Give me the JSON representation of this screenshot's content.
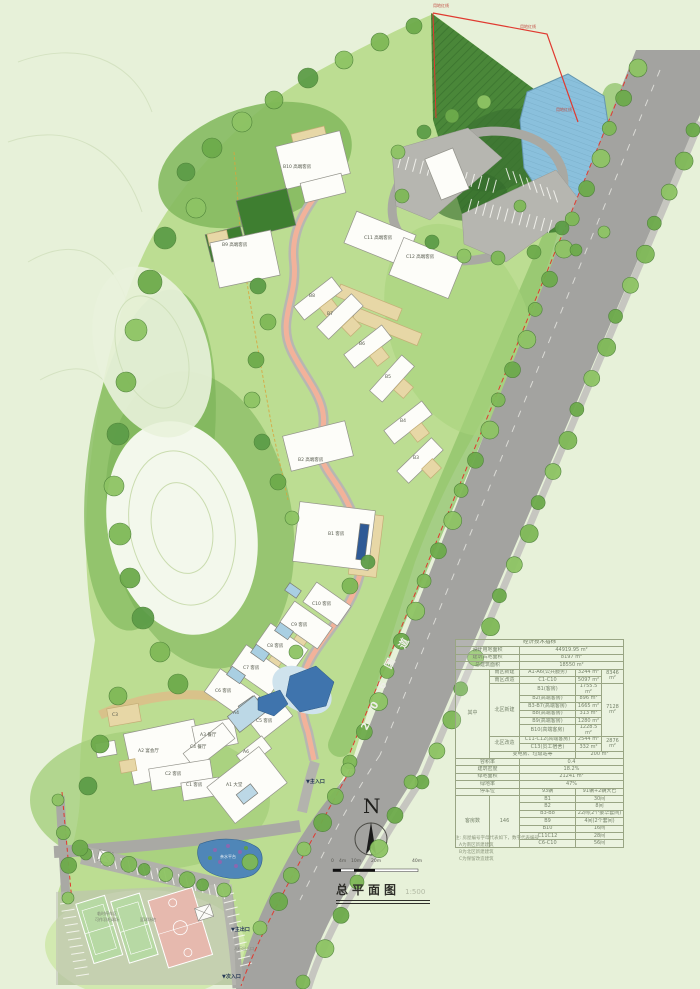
{
  "title": {
    "text": "总平面图",
    "scale": "1:500"
  },
  "north": {
    "letter": "N"
  },
  "scale_bar": {
    "ticks": [
      {
        "x": 331,
        "t": "0"
      },
      {
        "x": 339,
        "t": "4m"
      },
      {
        "x": 351,
        "t": "10m"
      },
      {
        "x": 371,
        "t": "20m"
      },
      {
        "x": 412,
        "t": "40m"
      }
    ]
  },
  "road": {
    "name": "206国道",
    "chars": [
      {
        "x": 363,
        "y": 722,
        "t": "2"
      },
      {
        "x": 372,
        "y": 701,
        "t": "0"
      },
      {
        "x": 380,
        "y": 681,
        "t": "6"
      },
      {
        "x": 386,
        "y": 659,
        "t": "国"
      },
      {
        "x": 400,
        "y": 639,
        "t": "道"
      }
    ]
  },
  "boundary": {
    "label": "用地红线",
    "positions": [
      [
        433,
        4
      ],
      [
        520,
        25
      ],
      [
        556,
        108
      ]
    ]
  },
  "entrances": [
    {
      "x": 306,
      "y": 780,
      "t": "▼主入口"
    },
    {
      "x": 231,
      "y": 928,
      "t": "▼主出口"
    },
    {
      "x": 234,
      "y": 947,
      "t": "人行出入口",
      "c": "s4g"
    },
    {
      "x": 222,
      "y": 975,
      "t": "▼次入口"
    }
  ],
  "building_labels": [
    {
      "x": 283,
      "y": 166,
      "t": "B10 高端客房"
    },
    {
      "x": 222,
      "y": 244,
      "t": "B9 高端客房"
    },
    {
      "x": 364,
      "y": 237,
      "t": "C11 高端客房"
    },
    {
      "x": 406,
      "y": 256,
      "t": "C12 高端客房"
    },
    {
      "x": 309,
      "y": 295,
      "t": "B8"
    },
    {
      "x": 327,
      "y": 313,
      "t": "B7"
    },
    {
      "x": 359,
      "y": 343,
      "t": "B6"
    },
    {
      "x": 385,
      "y": 376,
      "t": "B5"
    },
    {
      "x": 400,
      "y": 420,
      "t": "B4"
    },
    {
      "x": 413,
      "y": 457,
      "t": "B3"
    },
    {
      "x": 298,
      "y": 459,
      "t": "B2 高端客房"
    },
    {
      "x": 328,
      "y": 533,
      "t": "B1 客房"
    },
    {
      "x": 312,
      "y": 603,
      "t": "C10 客房"
    },
    {
      "x": 291,
      "y": 624,
      "t": "C9 客房"
    },
    {
      "x": 267,
      "y": 645,
      "t": "C8 客房"
    },
    {
      "x": 243,
      "y": 667,
      "t": "C7 客房"
    },
    {
      "x": 215,
      "y": 690,
      "t": "C6 客房"
    },
    {
      "x": 256,
      "y": 720,
      "t": "C5 客房"
    },
    {
      "x": 233,
      "y": 712,
      "t": "A4"
    },
    {
      "x": 200,
      "y": 734,
      "t": "A3 餐厅"
    },
    {
      "x": 190,
      "y": 746,
      "t": "C4 餐厅"
    },
    {
      "x": 138,
      "y": 750,
      "t": "A2 宴会厅"
    },
    {
      "x": 243,
      "y": 751,
      "t": "A6"
    },
    {
      "x": 112,
      "y": 714,
      "t": "C3"
    },
    {
      "x": 165,
      "y": 773,
      "t": "C2 客房"
    },
    {
      "x": 186,
      "y": 784,
      "t": "C1 客房"
    },
    {
      "x": 226,
      "y": 784,
      "t": "A1 大堂"
    }
  ],
  "site_labels": [
    {
      "x": 97,
      "y": 912,
      "t": "临时停车区",
      "c": "s4g"
    },
    {
      "x": 95,
      "y": 918,
      "t": "可作羽毛球场",
      "c": "s4g"
    },
    {
      "x": 140,
      "y": 918,
      "t": "篮球场地",
      "c": "s4g"
    },
    {
      "x": 220,
      "y": 855,
      "t": "亲水平台",
      "c": "s4w"
    }
  ],
  "table": {
    "title": "经济技术指标",
    "rows": [
      [
        {
          "t": "设计用地面积",
          "cs": 2
        },
        {
          "t": "44919.95 m²",
          "cs": 3
        }
      ],
      [
        {
          "t": "建筑占地面积",
          "cs": 2
        },
        {
          "t": "8197 m²",
          "cs": 3
        }
      ],
      [
        {
          "t": "总建筑面积",
          "cs": 2
        },
        {
          "t": "18550 m²",
          "cs": 3
        }
      ],
      [
        {
          "t": "其中",
          "rs": 11
        },
        {
          "t": "南区新建"
        },
        {
          "t": "A1-A6(公共服务)"
        },
        {
          "t": "3244 m²"
        },
        {
          "t": "8346 m²",
          "rs": 2
        }
      ],
      [
        {
          "t": "南区改造"
        },
        {
          "t": "C1-C10"
        },
        {
          "t": "5097 m²"
        }
      ],
      [
        {
          "t": "北区新建",
          "rs": 6
        },
        {
          "t": "B1(客房)"
        },
        {
          "t": "1755.5 m²"
        },
        {
          "t": "7128 m²",
          "rs": 6
        }
      ],
      [
        {
          "t": "B2(高端客房)"
        },
        {
          "t": "896 m²"
        }
      ],
      [
        {
          "t": "B3-B7(高端客房)"
        },
        {
          "t": "1665 m²"
        }
      ],
      [
        {
          "t": "B8(高端客房)"
        },
        {
          "t": "313 m²"
        }
      ],
      [
        {
          "t": "B9(高端客房)"
        },
        {
          "t": "1280 m²"
        }
      ],
      [
        {
          "t": "B10(高端客房)"
        },
        {
          "t": "1228.5 m²"
        }
      ],
      [
        {
          "t": "北区改造",
          "rs": 2
        },
        {
          "t": "C11-C12(高端客房)"
        },
        {
          "t": "2544 m²"
        },
        {
          "t": "2876 m²",
          "rs": 2
        }
      ],
      [
        {
          "t": "C13(员工宿舍)"
        },
        {
          "t": "332 m²"
        }
      ],
      [
        {
          "t": "变电房、垃圾站等",
          "cs": 2
        },
        {
          "t": "200 m²",
          "cs": 2
        }
      ],
      [
        {
          "t": "容积率",
          "cs": 2
        },
        {
          "t": "0.4",
          "cs": 3
        }
      ],
      [
        {
          "t": "建筑密度",
          "cs": 2
        },
        {
          "t": "18.2%",
          "cs": 3
        }
      ],
      [
        {
          "t": "绿地面积",
          "cs": 2
        },
        {
          "t": "21241 m²",
          "cs": 3
        }
      ],
      [
        {
          "t": "绿地率",
          "cs": 2
        },
        {
          "t": "47%",
          "cs": 3
        }
      ],
      [
        {
          "t": "停车位",
          "cs": 2
        },
        {
          "t": "93辆"
        },
        {
          "t": "91辆+2辆大巴",
          "cs": 2
        }
      ],
      [
        {
          "t": "客房数",
          "rs": 7
        },
        {
          "t": "146",
          "rs": 7
        },
        {
          "t": "B1"
        },
        {
          "t": "30间",
          "cs": 2
        }
      ],
      [
        {
          "t": "B2"
        },
        {
          "t": "8间",
          "cs": 2
        }
      ],
      [
        {
          "t": "B3-B8"
        },
        {
          "t": "22间(2个豪华套间)",
          "cs": 2
        }
      ],
      [
        {
          "t": "B9"
        },
        {
          "t": "4间(2个套间)",
          "cs": 2
        }
      ],
      [
        {
          "t": "B10"
        },
        {
          "t": "16间",
          "cs": 2
        }
      ],
      [
        {
          "t": "C11C12"
        },
        {
          "t": "28间",
          "cs": 2
        }
      ],
      [
        {
          "t": "C6-C10"
        },
        {
          "t": "56间",
          "cs": 2
        }
      ]
    ]
  },
  "notes": [
    "注: 房屋编号字母代表如下，数字代表编号",
    "A为南区新建建筑",
    "B为北区新建建筑",
    "C为保留改造建筑"
  ]
}
